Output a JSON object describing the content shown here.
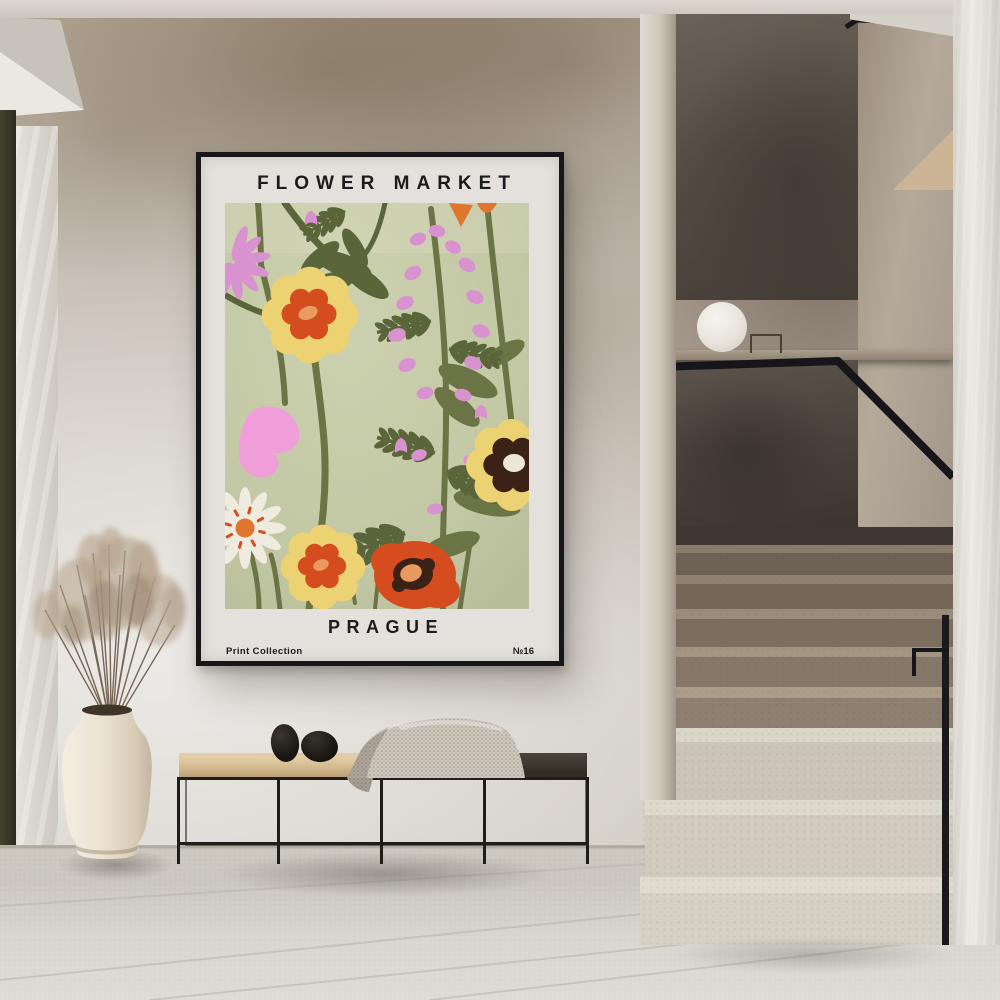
{
  "poster": {
    "title": "FLOWER MARKET",
    "city": "PRAGUE",
    "collection_label": "Print Collection",
    "edition_number": "№16"
  },
  "scene": {
    "description": "Framed 'Flower Market Prague' art print hanging on a textured plaster wall beside a staircase with a smoked-glass balustrade, above a black metal bench with a knit throw and two black stones, next to a cream vase holding dried pampas grass",
    "objects": [
      "framed-poster",
      "plaster-wall",
      "staircase",
      "glass-balustrade",
      "black-handrail",
      "sphere-lamp",
      "terrazzo-steps",
      "metal-bench",
      "throw-blanket",
      "decorative-stones",
      "ceramic-vase",
      "dried-pampas-grass",
      "tiled-floor",
      "door-frame"
    ]
  },
  "palette": {
    "ink": "#1c1c1e",
    "frame": "#17171a",
    "poster_bg": "#e4e1dc",
    "art_bg": "#c2c7a4",
    "olive": "#6b7444",
    "olive_dark": "#5a663a",
    "pink": "#d892cf",
    "pink_bright": "#ef9ed9",
    "yellow": "#ecd273",
    "red_orange": "#d54d1f",
    "orange": "#e0762e",
    "peach": "#e89a61",
    "dark_brown": "#3a2316",
    "cream": "#ece7d8",
    "white_petal": "#f0ebdf",
    "wall": "#c9c2b8",
    "glass": "#4f473e",
    "stair_dark": "#7c6f60",
    "stair_light": "#d7d2c7",
    "metal": "#1b1b1d",
    "wood": "#d8bf97",
    "wood_dark": "#3a342c",
    "blanket": "#cec7bc",
    "stone": "#22201c",
    "vase": "#ebe3d4",
    "grass": "#b3a28b",
    "floor": "#d2cfc8"
  }
}
